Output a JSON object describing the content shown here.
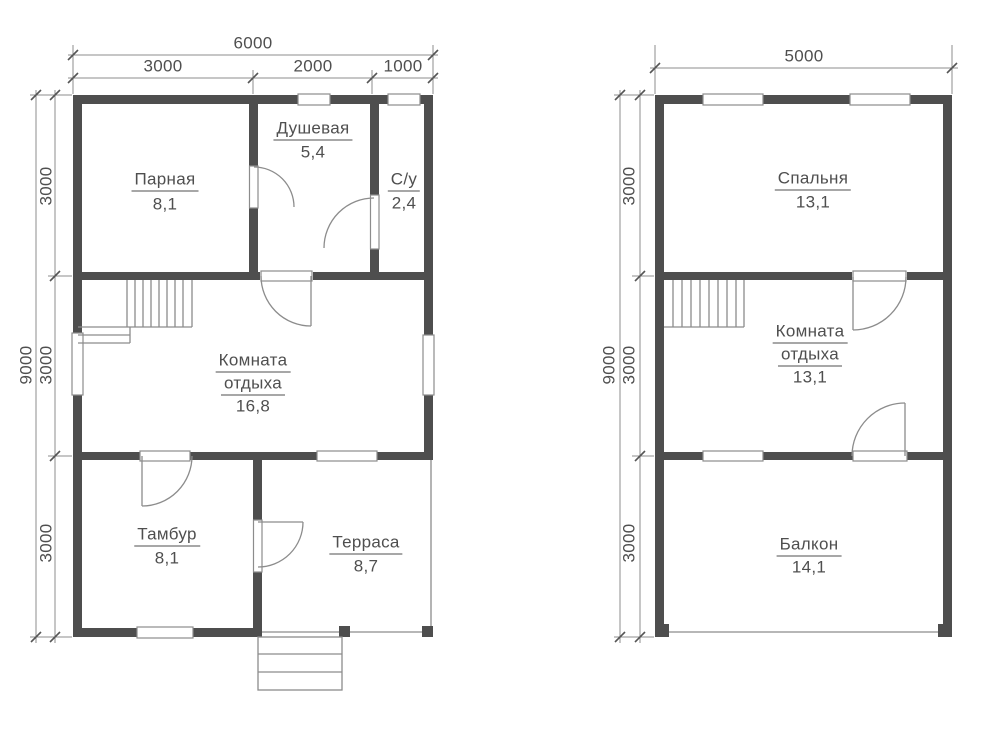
{
  "colors": {
    "wall": "#4e4e4e",
    "line": "#8c8c8c",
    "tick": "#555555",
    "text": "#4f4f4f",
    "background": "#ffffff"
  },
  "floor1": {
    "dim_total_width": "6000",
    "dim_width_segments": [
      "3000",
      "2000",
      "1000"
    ],
    "dim_total_height": "9000",
    "dim_height_segments": [
      "3000",
      "3000",
      "3000"
    ],
    "rooms": {
      "parnaya": {
        "name": "Парная",
        "area": "8,1"
      },
      "dushevaya": {
        "name": "Душевая",
        "area": "5,4"
      },
      "su": {
        "name": "С/у",
        "area": "2,4"
      },
      "komnata": {
        "name_line1": "Комната",
        "name_line2": "отдыха",
        "area": "16,8"
      },
      "tambur": {
        "name": "Тамбур",
        "area": "8,1"
      },
      "terrasa": {
        "name": "Терраса",
        "area": "8,7"
      }
    }
  },
  "floor2": {
    "dim_total_width": "5000",
    "dim_total_height": "9000",
    "dim_height_segments": [
      "3000",
      "3000",
      "3000"
    ],
    "rooms": {
      "spalnya": {
        "name": "Спальня",
        "area": "13,1"
      },
      "komnata": {
        "name_line1": "Комната",
        "name_line2": "отдыха",
        "area": "13,1"
      },
      "balkon": {
        "name": "Балкон",
        "area": "14,1"
      }
    }
  }
}
